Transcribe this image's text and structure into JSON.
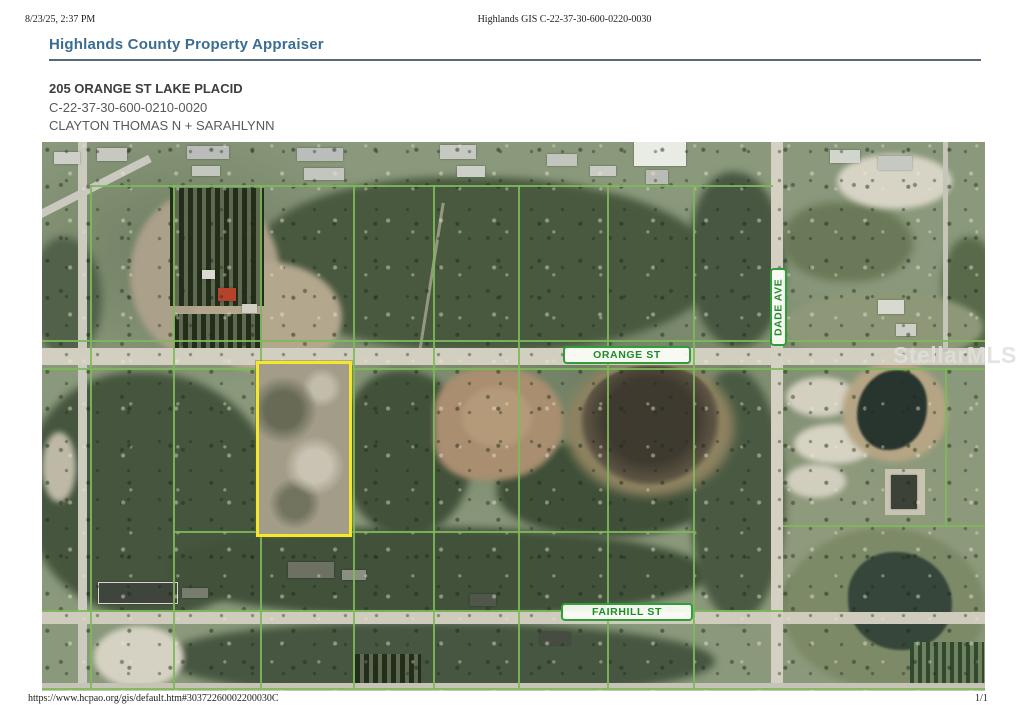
{
  "print": {
    "timestamp": "8/23/25, 2:37 PM",
    "header_title": "Highlands GIS C-22-37-30-600-0220-0030",
    "footer_url": "https://www.hcpao.org/gis/default.htm#30372260002200030C",
    "page_number": "1/1"
  },
  "header": {
    "site_title": "Highlands County Property Appraiser"
  },
  "property": {
    "address": "205 ORANGE ST LAKE PLACID",
    "parcel_id": "C-22-37-30-600-0210-0020",
    "owner": "CLAYTON THOMAS N + SARAHLYNN"
  },
  "map": {
    "orange_st_label": "ORANGE ST",
    "dade_ave_label": "DADE AVE",
    "fairhill_st_label": "FAIRHILL ST",
    "watermark": "StellarMLS",
    "colors": {
      "label_green": "#1f8c2a",
      "parcel_line_green": "#7db95a",
      "subject_highlight_yellow": "#f4e72e",
      "title_blue": "#3b6d91"
    }
  }
}
